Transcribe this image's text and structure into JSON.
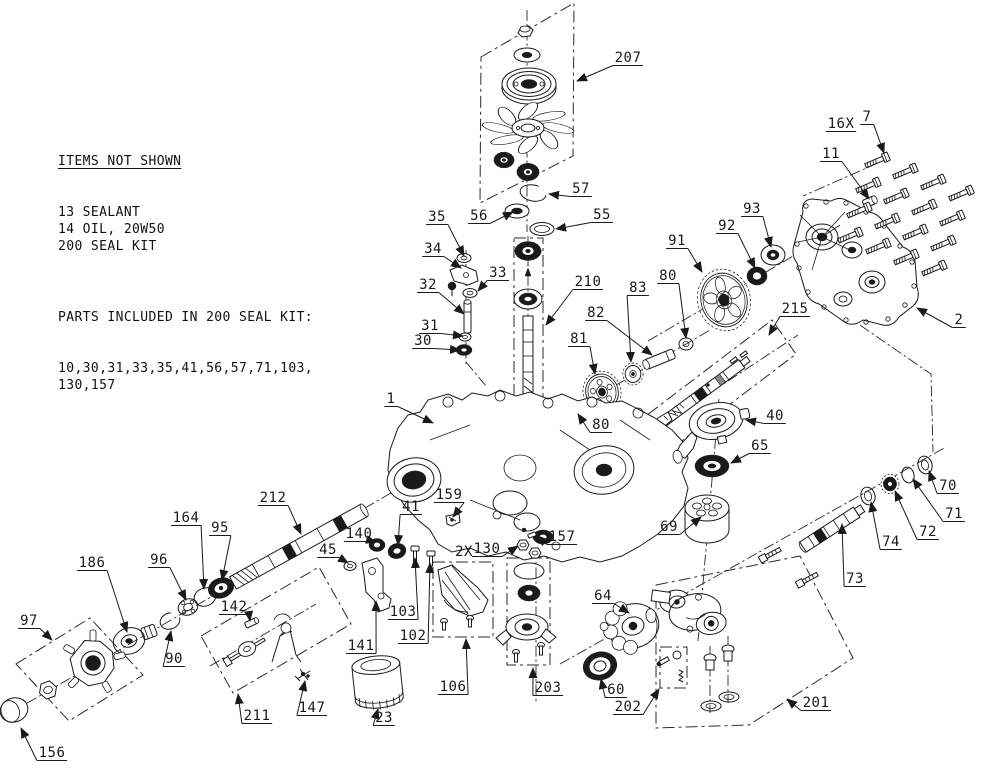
{
  "notes": {
    "heading": "ITEMS NOT SHOWN",
    "items": [
      "13 SEALANT",
      "14 OIL, 20W50",
      "200 SEAL KIT"
    ],
    "kit_heading": "PARTS INCLUDED IN 200 SEAL KIT:",
    "kit_lines": [
      "10,30,31,33,35,41,56,57,71,103,",
      "130,157"
    ]
  },
  "colors": {
    "line": "#1a1a1a",
    "background": "#ffffff"
  },
  "screw_grid": {
    "origin": [
      884,
      158
    ],
    "col": [
      28,
      11
    ],
    "row": [
      -9,
      25
    ],
    "cols": 4,
    "rows": 4
  },
  "labels": [
    {
      "t": "207",
      "x": 628,
      "y": 62,
      "tx": 577,
      "ty": 81
    },
    {
      "t": "57",
      "x": 581,
      "y": 193,
      "tx": 549,
      "ty": 194
    },
    {
      "t": "56",
      "x": 479,
      "y": 220,
      "tx": 513,
      "ty": 212
    },
    {
      "t": "55",
      "x": 602,
      "y": 219,
      "tx": 556,
      "ty": 229
    },
    {
      "t": "35",
      "x": 437,
      "y": 221,
      "tx": 464,
      "ty": 256
    },
    {
      "t": "34",
      "x": 433,
      "y": 253,
      "tx": 461,
      "ty": 268
    },
    {
      "t": "33",
      "x": 498,
      "y": 277,
      "tx": 478,
      "ty": 291
    },
    {
      "t": "32",
      "x": 428,
      "y": 289,
      "tx": 464,
      "ty": 314
    },
    {
      "t": "31",
      "x": 430,
      "y": 330,
      "tx": 463,
      "ty": 336
    },
    {
      "t": "30",
      "x": 423,
      "y": 345,
      "tx": 460,
      "ty": 350
    },
    {
      "t": "210",
      "x": 588,
      "y": 286,
      "tx": 546,
      "ty": 325
    },
    {
      "t": "16X",
      "x": 841,
      "y": 128,
      "a": false
    },
    {
      "t": "7",
      "x": 867,
      "y": 121,
      "tx": 884,
      "ty": 153
    },
    {
      "t": "11",
      "x": 831,
      "y": 158,
      "tx": 869,
      "ty": 199
    },
    {
      "t": "93",
      "x": 752,
      "y": 213,
      "tx": 771,
      "ty": 247
    },
    {
      "t": "92",
      "x": 727,
      "y": 230,
      "tx": 755,
      "ty": 268
    },
    {
      "t": "91",
      "x": 677,
      "y": 245,
      "tx": 702,
      "ty": 272
    },
    {
      "t": "2",
      "x": 959,
      "y": 324,
      "tx": 917,
      "ty": 308
    },
    {
      "t": "215",
      "x": 795,
      "y": 313,
      "tx": 769,
      "ty": 335
    },
    {
      "t": "83",
      "x": 638,
      "y": 292,
      "tx": 631,
      "ty": 362
    },
    {
      "t": "80",
      "x": 668,
      "y": 280,
      "tx": 686,
      "ty": 338
    },
    {
      "t": "82",
      "x": 596,
      "y": 317,
      "tx": 652,
      "ty": 355
    },
    {
      "t": "81",
      "x": 579,
      "y": 343,
      "tx": 595,
      "ty": 374
    },
    {
      "t": "1",
      "x": 391,
      "y": 403,
      "tx": 433,
      "ty": 423
    },
    {
      "t": "80",
      "x": 601,
      "y": 429,
      "tx": 578,
      "ty": 414
    },
    {
      "t": "40",
      "x": 775,
      "y": 420,
      "tx": 746,
      "ty": 420
    },
    {
      "t": "65",
      "x": 760,
      "y": 450,
      "tx": 731,
      "ty": 463
    },
    {
      "t": "69",
      "x": 669,
      "y": 531,
      "tx": 701,
      "ty": 517
    },
    {
      "t": "70",
      "x": 948,
      "y": 490,
      "tx": 929,
      "ty": 471
    },
    {
      "t": "71",
      "x": 954,
      "y": 518,
      "tx": 913,
      "ty": 479
    },
    {
      "t": "72",
      "x": 928,
      "y": 536,
      "tx": 895,
      "ty": 491
    },
    {
      "t": "74",
      "x": 891,
      "y": 546,
      "tx": 871,
      "ty": 502
    },
    {
      "t": "73",
      "x": 855,
      "y": 583,
      "tx": 842,
      "ty": 524
    },
    {
      "t": "212",
      "x": 273,
      "y": 502,
      "tx": 301,
      "ty": 534
    },
    {
      "t": "164",
      "x": 186,
      "y": 522,
      "tx": 204,
      "ty": 589
    },
    {
      "t": "95",
      "x": 220,
      "y": 532,
      "tx": 222,
      "ty": 580
    },
    {
      "t": "96",
      "x": 159,
      "y": 564,
      "tx": 186,
      "ty": 600
    },
    {
      "t": "186",
      "x": 92,
      "y": 567,
      "tx": 127,
      "ty": 632
    },
    {
      "t": "45",
      "x": 328,
      "y": 554,
      "tx": 348,
      "ty": 563
    },
    {
      "t": "140",
      "x": 359,
      "y": 538,
      "tx": 376,
      "ty": 542
    },
    {
      "t": "41",
      "x": 411,
      "y": 511,
      "tx": 398,
      "ty": 545
    },
    {
      "t": "159",
      "x": 449,
      "y": 499,
      "tx": 453,
      "ty": 517
    },
    {
      "t": "2X",
      "x": 464,
      "y": 556,
      "a": false,
      "u": false
    },
    {
      "t": "130",
      "x": 487,
      "y": 553,
      "tx": 518,
      "ty": 546
    },
    {
      "t": "157",
      "x": 562,
      "y": 541,
      "tx": 538,
      "ty": 536
    },
    {
      "t": "97",
      "x": 29,
      "y": 625,
      "tx": 52,
      "ty": 640
    },
    {
      "t": "90",
      "x": 174,
      "y": 663,
      "tx": 171,
      "ty": 631
    },
    {
      "t": "142",
      "x": 234,
      "y": 611,
      "tx": 250,
      "ty": 621
    },
    {
      "t": "103",
      "x": 403,
      "y": 616,
      "tx": 415,
      "ty": 558
    },
    {
      "t": "102",
      "x": 413,
      "y": 640,
      "tx": 430,
      "ty": 563
    },
    {
      "t": "106",
      "x": 453,
      "y": 691,
      "tx": 466,
      "ty": 639
    },
    {
      "t": "203",
      "x": 548,
      "y": 692,
      "tx": 533,
      "ty": 668
    },
    {
      "t": "64",
      "x": 603,
      "y": 600,
      "tx": 629,
      "ty": 613
    },
    {
      "t": "60",
      "x": 616,
      "y": 694,
      "tx": 601,
      "ty": 679
    },
    {
      "t": "202",
      "x": 628,
      "y": 711,
      "tx": 659,
      "ty": 689
    },
    {
      "t": "201",
      "x": 816,
      "y": 707,
      "tx": 787,
      "ty": 699
    },
    {
      "t": "141",
      "x": 361,
      "y": 650,
      "tx": 376,
      "ty": 601
    },
    {
      "t": "147",
      "x": 312,
      "y": 712,
      "tx": 305,
      "ty": 681
    },
    {
      "t": "23",
      "x": 384,
      "y": 722,
      "tx": 378,
      "ty": 709
    },
    {
      "t": "211",
      "x": 257,
      "y": 720,
      "tx": 238,
      "ty": 694
    },
    {
      "t": "156",
      "x": 52,
      "y": 757,
      "tx": 21,
      "ty": 728
    }
  ]
}
